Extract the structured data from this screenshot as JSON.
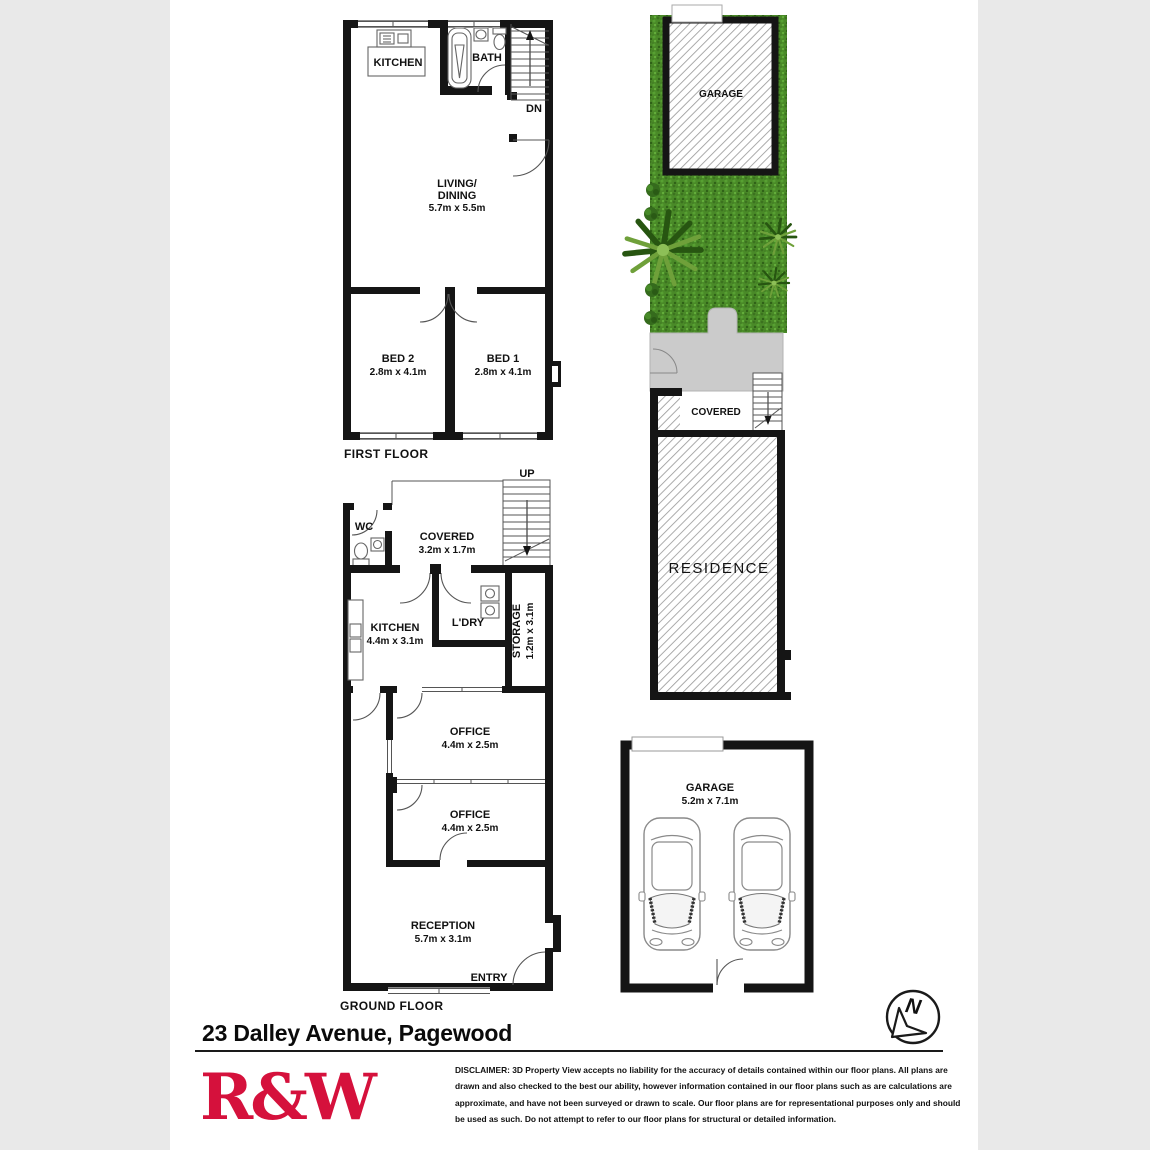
{
  "header": {
    "address": "23 Dalley Avenue, Pagewood"
  },
  "first_floor": {
    "floor_label": "FIRST FLOOR",
    "kitchen": "KITCHEN",
    "bath": "BATH",
    "dn": "DN",
    "living_line1": "LIVING/",
    "living_line2": "DINING",
    "living_dims": "5.7m x 5.5m",
    "bed2": "BED 2",
    "bed2_dims": "2.8m x 4.1m",
    "bed1": "BED 1",
    "bed1_dims": "2.8m x 4.1m"
  },
  "ground_floor": {
    "floor_label": "GROUND FLOOR",
    "up": "UP",
    "wc": "WC",
    "covered": "COVERED",
    "covered_dims": "3.2m x 1.7m",
    "kitchen": "KITCHEN",
    "kitchen_dims": "4.4m x 3.1m",
    "ldry": "L'DRY",
    "storage": "STORAGE",
    "storage_dims": "1.2m x 3.1m",
    "office1": "OFFICE",
    "office1_dims": "4.4m x 2.5m",
    "office2": "OFFICE",
    "office2_dims": "4.4m x 2.5m",
    "reception": "RECEPTION",
    "reception_dims": "5.7m x 3.1m",
    "entry": "ENTRY"
  },
  "site_plan": {
    "garage": "GARAGE",
    "covered": "COVERED",
    "residence": "RESIDENCE"
  },
  "garage_plan": {
    "garage": "GARAGE",
    "garage_dims": "5.2m x 7.1m"
  },
  "compass": {
    "north": "N"
  },
  "branding": {
    "logo_text": "R&W",
    "logo_color": "#d5113c"
  },
  "disclaimer": {
    "lines": [
      "DISCLAIMER: 3D Property View accepts no liability for the accuracy of details contained within our floor plans. All plans are",
      "drawn and also checked to the best our ability, however information contained in our floor plans such as are calculations are",
      "approximate, and have not been surveyed or drawn to scale. Our floor plans are for representational purposes only and should",
      "be used as such. Do not attempt to refer to our floor plans for structural or detailed information."
    ]
  }
}
